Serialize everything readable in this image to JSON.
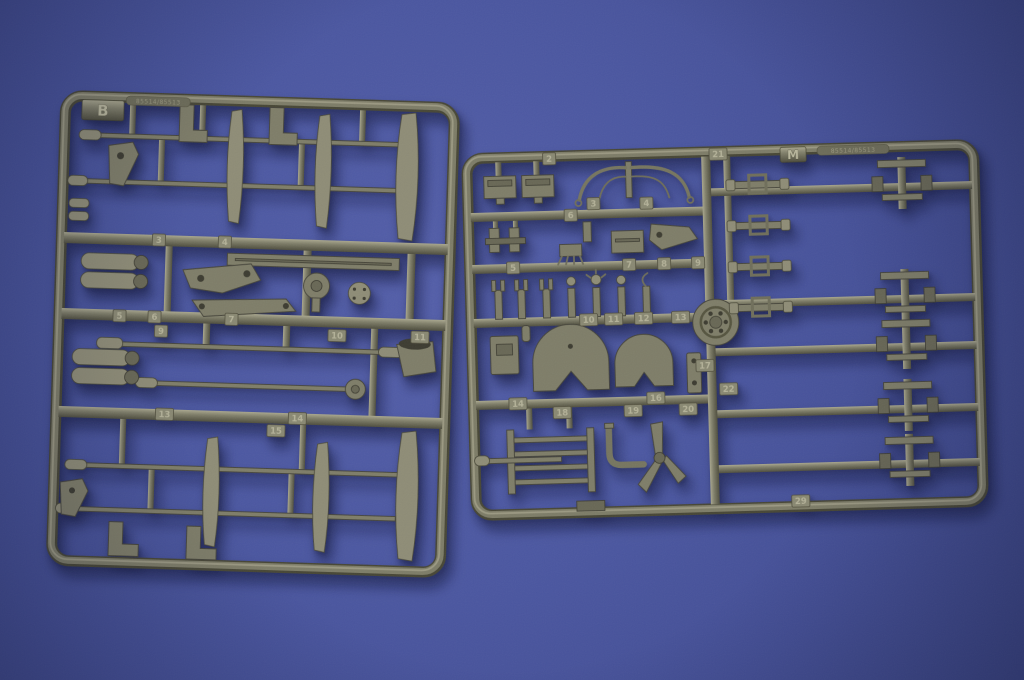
{
  "scene": {
    "subject": "Photograph of two olive-drab injection-molded plastic model kit sprues on a blue backdrop",
    "background_color": "#4a56a0",
    "plastic_color": "#7e7d68",
    "plastic_highlight": "#a9a78e",
    "plastic_shadow": "#4e4d3d"
  },
  "sprues": [
    {
      "id": "b",
      "letter": "B",
      "embossed_code": "85514/85513",
      "part_tags": [
        {
          "n": "3",
          "x": 103,
          "y": 147
        },
        {
          "n": "4",
          "x": 169,
          "y": 147
        },
        {
          "n": "5",
          "x": 66,
          "y": 224
        },
        {
          "n": "6",
          "x": 101,
          "y": 224
        },
        {
          "n": "7",
          "x": 178,
          "y": 224
        },
        {
          "n": "9",
          "x": 108,
          "y": 238
        },
        {
          "n": "10",
          "x": 284,
          "y": 237
        },
        {
          "n": "11",
          "x": 367,
          "y": 236
        },
        {
          "n": "13",
          "x": 114,
          "y": 321
        },
        {
          "n": "14",
          "x": 247,
          "y": 321
        },
        {
          "n": "15",
          "x": 226,
          "y": 334
        }
      ]
    },
    {
      "id": "m",
      "letter": "M",
      "embossed_code": "85514/85513",
      "part_tags": [
        {
          "n": "2",
          "x": 88,
          "y": 8
        },
        {
          "n": "21",
          "x": 257,
          "y": 8
        },
        {
          "n": "3",
          "x": 131,
          "y": 54
        },
        {
          "n": "4",
          "x": 184,
          "y": 55
        },
        {
          "n": "6",
          "x": 108,
          "y": 65
        },
        {
          "n": "5",
          "x": 49,
          "y": 116
        },
        {
          "n": "7",
          "x": 165,
          "y": 116
        },
        {
          "n": "8",
          "x": 200,
          "y": 116
        },
        {
          "n": "9",
          "x": 234,
          "y": 116
        },
        {
          "n": "10",
          "x": 123,
          "y": 170
        },
        {
          "n": "11",
          "x": 148,
          "y": 170
        },
        {
          "n": "12",
          "x": 178,
          "y": 170
        },
        {
          "n": "13",
          "x": 215,
          "y": 170
        },
        {
          "n": "17",
          "x": 238,
          "y": 219
        },
        {
          "n": "22",
          "x": 261,
          "y": 243
        },
        {
          "n": "14",
          "x": 50,
          "y": 252
        },
        {
          "n": "16",
          "x": 188,
          "y": 250
        },
        {
          "n": "18",
          "x": 94,
          "y": 262
        },
        {
          "n": "19",
          "x": 165,
          "y": 262
        },
        {
          "n": "20",
          "x": 220,
          "y": 262
        },
        {
          "n": "29",
          "x": 330,
          "y": 357
        }
      ]
    }
  ]
}
